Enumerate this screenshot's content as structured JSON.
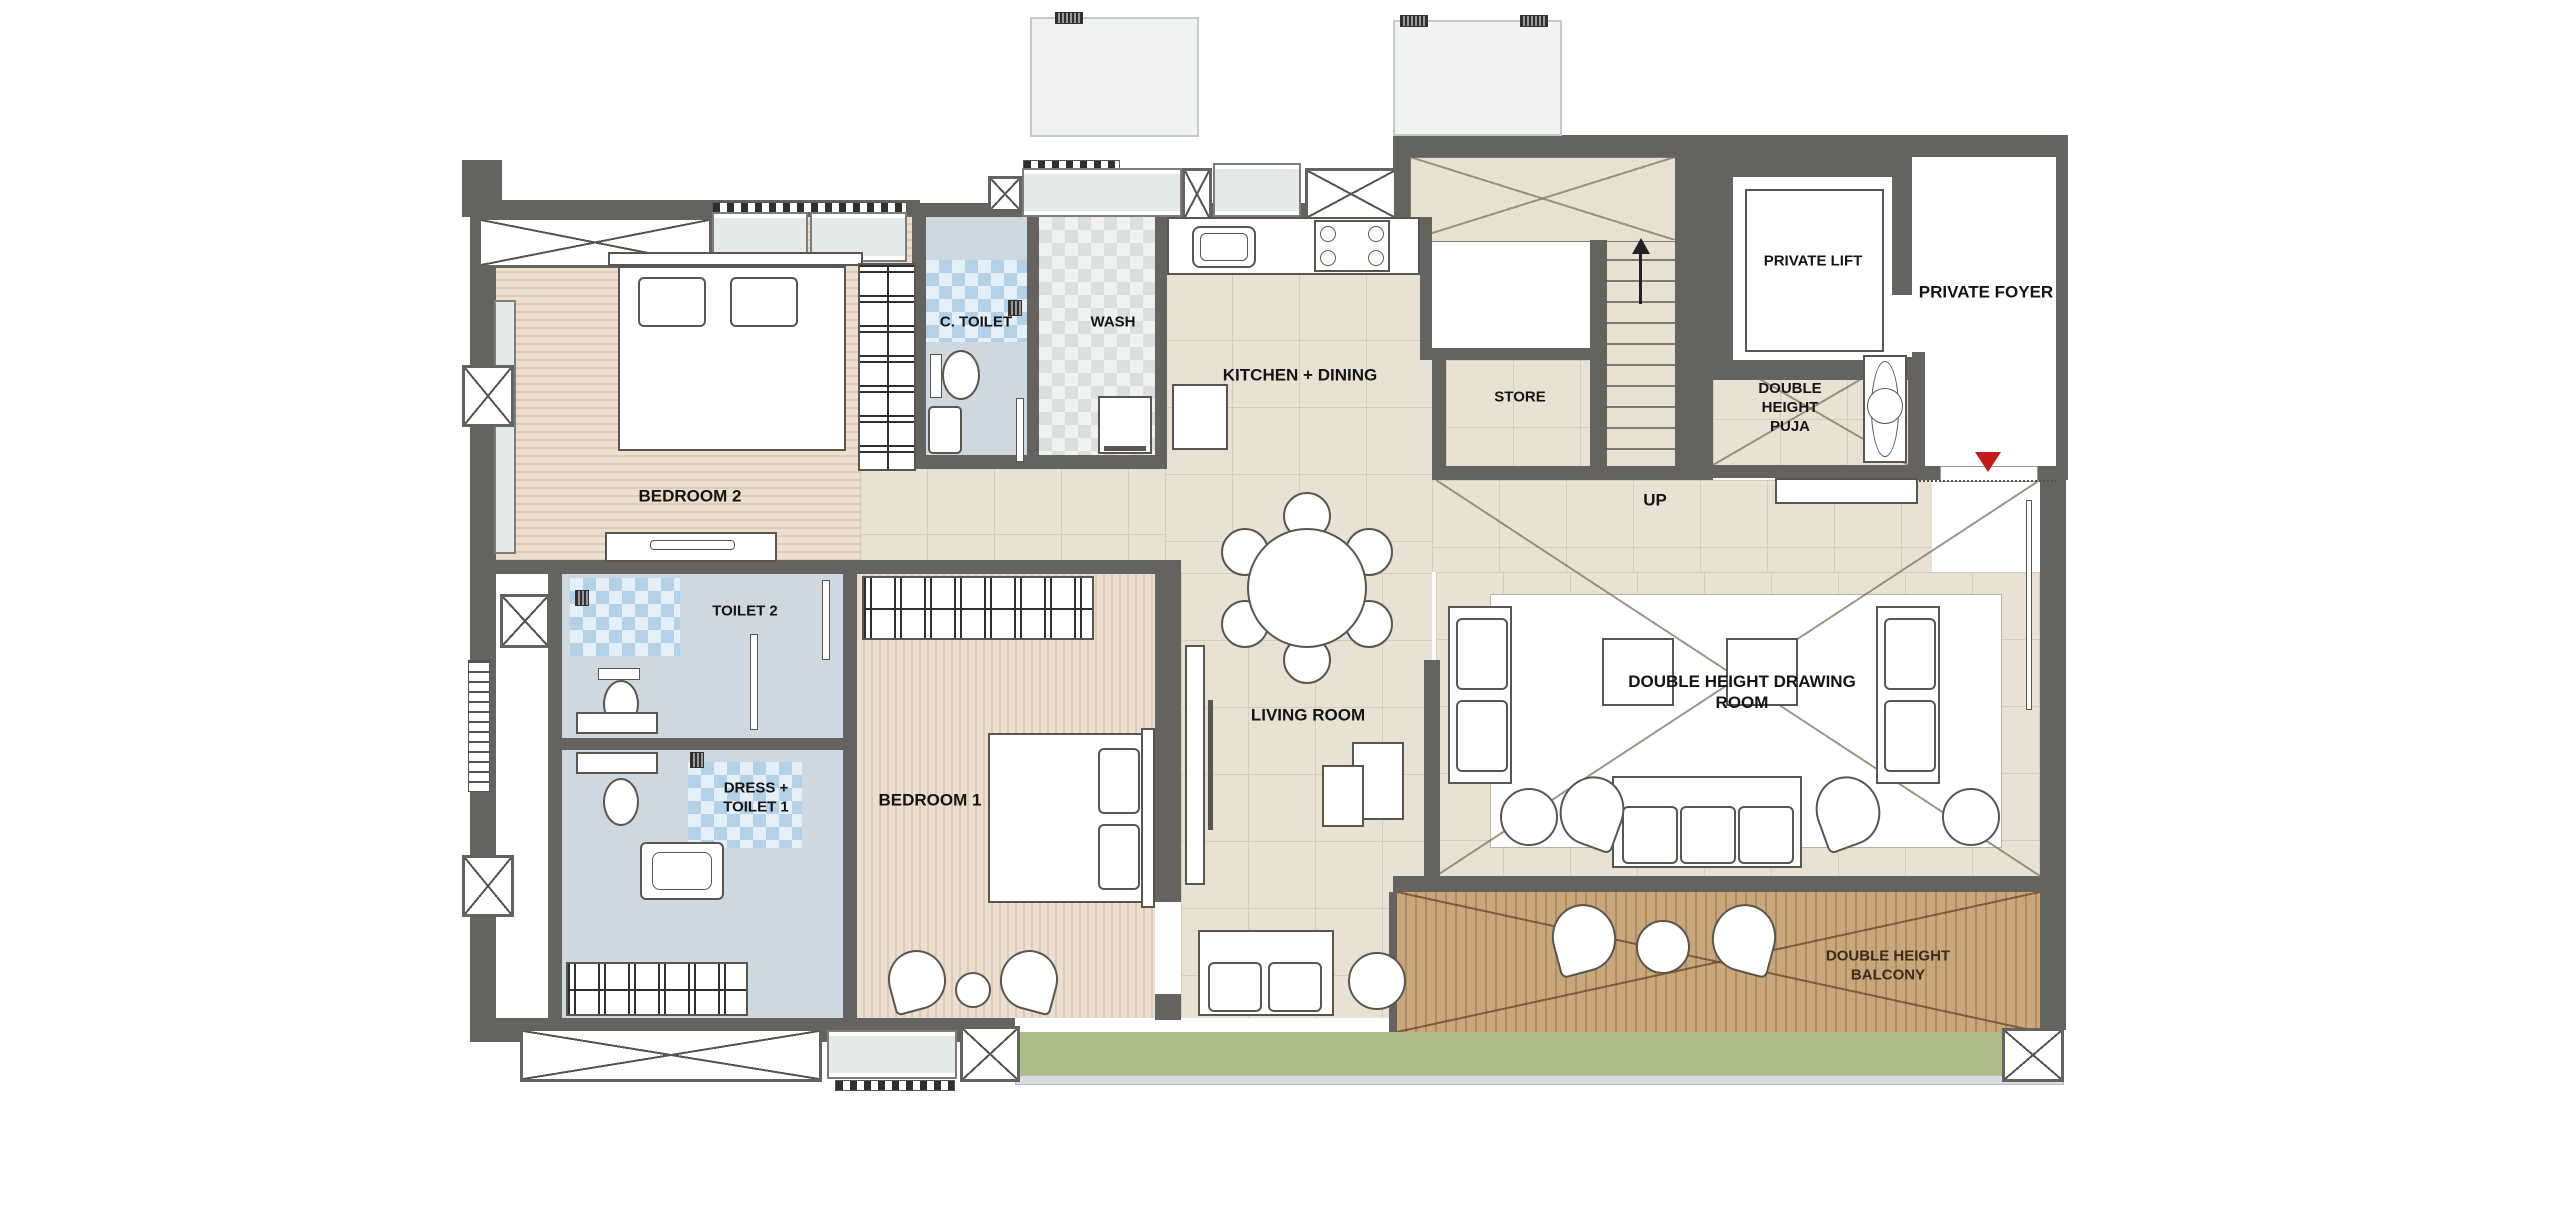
{
  "title": "Residential apartment floor plan",
  "rooms": {
    "bedroom2": "BEDROOM 2",
    "c_toilet": "C. TOILET",
    "wash": "WASH",
    "kitchen_dining": "KITCHEN + DINING",
    "store": "STORE",
    "up": "UP",
    "private_lift": "PRIVATE LIFT",
    "private_foyer": "PRIVATE FOYER",
    "puja": "DOUBLE HEIGHT PUJA",
    "toilet2": "TOILET 2",
    "dress_toilet1": "DRESS + TOILET 1",
    "bedroom1": "BEDROOM 1",
    "living": "LIVING ROOM",
    "drawing": "DOUBLE HEIGHT DRAWING ROOM",
    "balcony": "DOUBLE HEIGHT BALCONY"
  },
  "colors": {
    "wall": "#65635f",
    "tile_floor": "#e9e2d4",
    "plank_floor": "#ecdfcf",
    "toilet_floor": "#cdd8e1",
    "blue_tile": "#b3d2e8",
    "gray_tile": "#dee1e2",
    "balcony_deck": "#c8a77d",
    "planter_green": "#abbd87",
    "rug_white": "#ffffff",
    "entry_marker_red": "#c11a1a"
  },
  "markers": {
    "entry": "entry-direction-triangle",
    "stair_direction": "up-arrow"
  }
}
